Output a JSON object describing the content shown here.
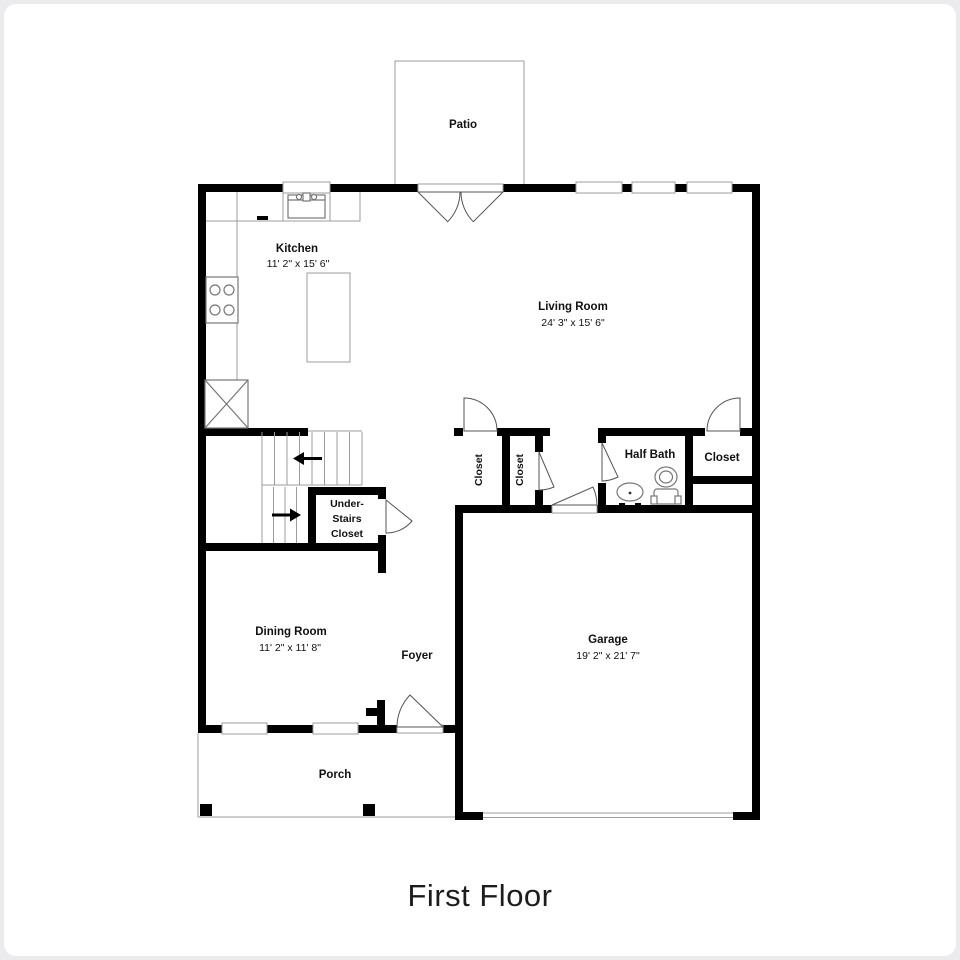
{
  "page": {
    "title": "First Floor"
  },
  "colors": {
    "wall": "#000000",
    "fixture-line": "#777777",
    "light-line": "#9c9c9c",
    "door-line": "#555555",
    "page-background": "#ebebed",
    "plan-background": "#ffffff",
    "label-text": "#111111",
    "title-text": "#1c1c1c"
  },
  "rooms": {
    "patio": {
      "label": "Patio"
    },
    "kitchen": {
      "label": "Kitchen",
      "dims": "11' 2\" x 15' 6\""
    },
    "living_room": {
      "label": "Living Room",
      "dims": "24' 3\" x 15' 6\""
    },
    "dining_room": {
      "label": "Dining Room",
      "dims": "11' 2\" x 11' 8\""
    },
    "foyer": {
      "label": "Foyer"
    },
    "garage": {
      "label": "Garage",
      "dims": "19' 2\" x 21' 7\""
    },
    "porch": {
      "label": "Porch"
    },
    "half_bath": {
      "label": "Half Bath"
    },
    "closet_hall_left": {
      "label": "Closet"
    },
    "closet_hall_right": {
      "label": "Closet"
    },
    "closet_living_right": {
      "label": "Closet"
    },
    "under_stairs_closet": {
      "line1": "Under-",
      "line2": "Stairs",
      "line3": "Closet"
    }
  }
}
